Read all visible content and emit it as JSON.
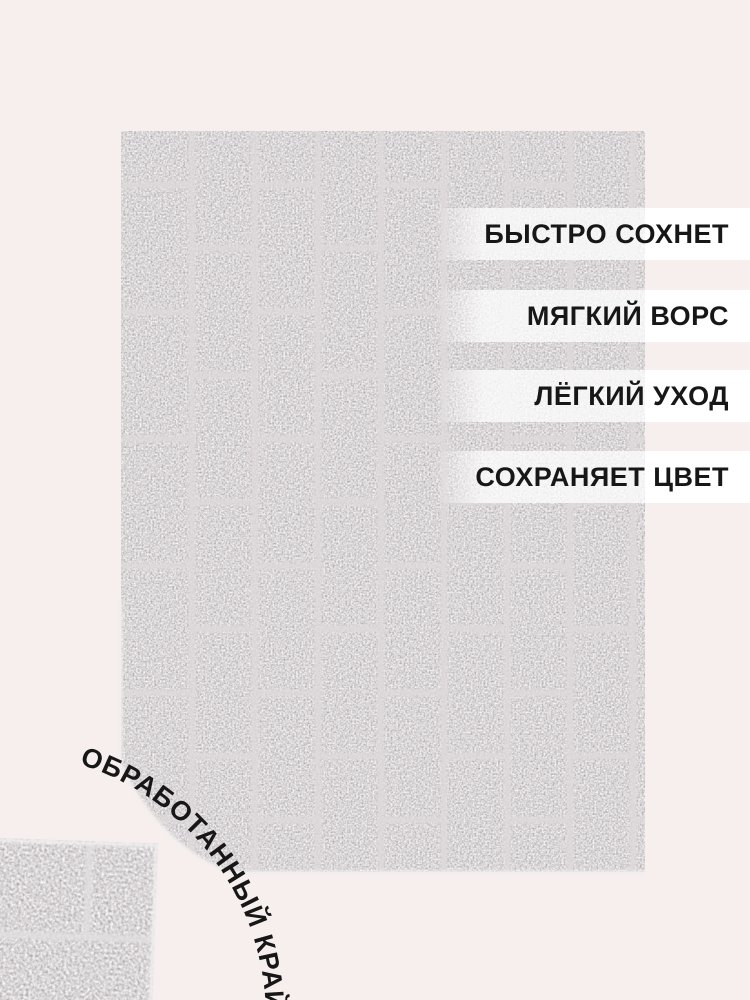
{
  "features": {
    "items": [
      {
        "label": "БЫСТРО СОХНЕТ"
      },
      {
        "label": "МЯГКИЙ ВОРС"
      },
      {
        "label": "ЛЁГКИЙ УХОД"
      },
      {
        "label": "СОХРАНЯЕТ ЦВЕТ"
      }
    ]
  },
  "edge_label": {
    "text": "ОБРАБОТАННЫЙ КРАЙ"
  },
  "colors": {
    "background": "#f6efee",
    "band_white": "#ffffff",
    "label_text": "#171717",
    "rug_gray": "#aeaaad",
    "grout_light": "#ded9da",
    "edge_fringe": "#f0edec"
  }
}
